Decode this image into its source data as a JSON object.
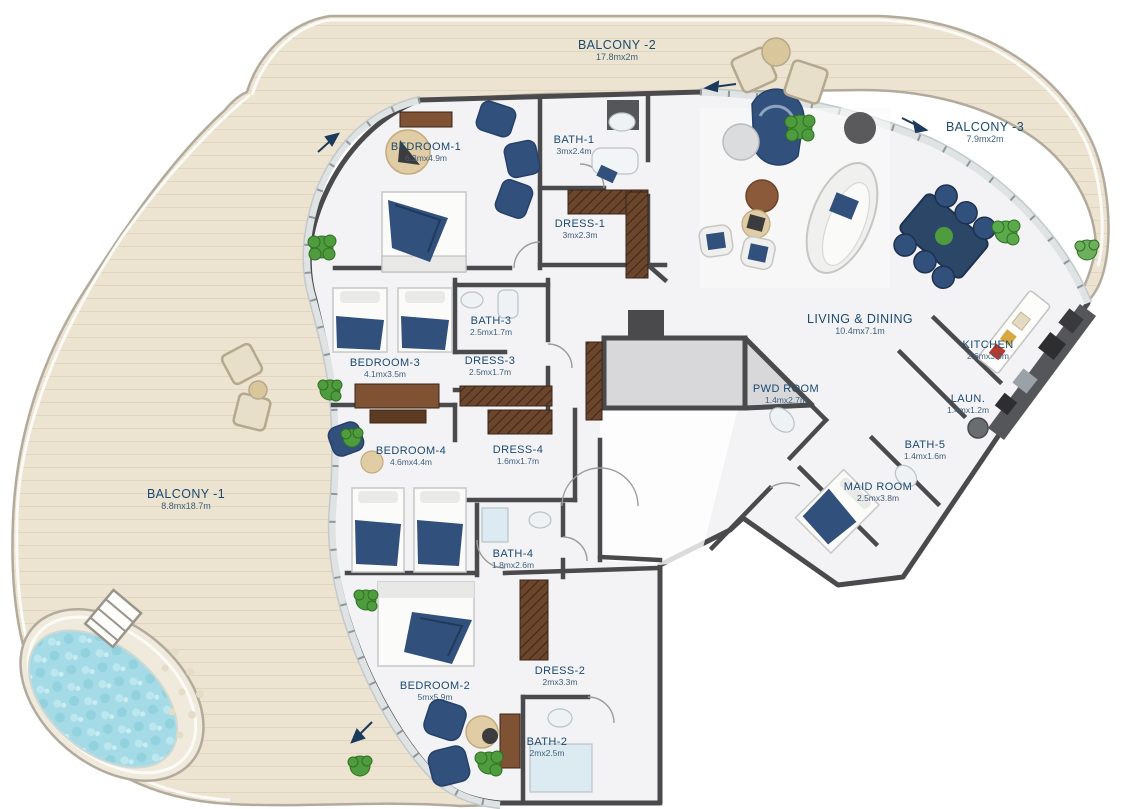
{
  "plan": {
    "type": "apartment-floor-plan",
    "colors": {
      "label_text": "#1b4a70",
      "dims_text": "#40607b",
      "wall": "#4a4a4c",
      "balcony_floor": "#ece3d1",
      "interior_floor": "#f3f3f5",
      "pool_water": "#a5dbe6",
      "furniture_navy": "#31507b",
      "wood": "#7e5233",
      "plant_green": "#4f9c3e"
    },
    "features": [
      "pool",
      "pool-ladder",
      "dining-table",
      "sofa-group",
      "kitchen-counter",
      "beds",
      "plants",
      "balcony-chairs"
    ]
  },
  "rooms": {
    "balcony1": {
      "name": "BALCONY -1",
      "dims": "8.8mx18.7m"
    },
    "balcony2": {
      "name": "BALCONY -2",
      "dims": "17.8mx2m"
    },
    "balcony3": {
      "name": "BALCONY -3",
      "dims": "7.9mx2m"
    },
    "bedroom1": {
      "name": "BEDROOM-1",
      "dims": "6.3mx4.9m"
    },
    "bath1": {
      "name": "BATH-1",
      "dims": "3mx2.4m"
    },
    "dress1": {
      "name": "DRESS-1",
      "dims": "3mx2.3m"
    },
    "living": {
      "name": "LIVING & DINING",
      "dims": "10.4mx7.1m"
    },
    "kitchen": {
      "name": "KITCHEN",
      "dims": "2.6mx3.9m"
    },
    "pwd": {
      "name": "PWD ROOM",
      "dims": "1.4mx2.7m"
    },
    "laun": {
      "name": "LAUN.",
      "dims": "1.4mx1.2m"
    },
    "bath5": {
      "name": "BATH-5",
      "dims": "1.4mx1.6m"
    },
    "maid": {
      "name": "MAID ROOM",
      "dims": "2.5mx3.8m"
    },
    "bath3": {
      "name": "BATH-3",
      "dims": "2.5mx1.7m"
    },
    "dress3": {
      "name": "DRESS-3",
      "dims": "2.5mx1.7m"
    },
    "bedroom3": {
      "name": "BEDROOM-3",
      "dims": "4.1mx3.5m"
    },
    "bedroom4": {
      "name": "BEDROOM-4",
      "dims": "4.6mx4.4m"
    },
    "dress4": {
      "name": "DRESS-4",
      "dims": "1.6mx1.7m"
    },
    "bath4": {
      "name": "BATH-4",
      "dims": "1.8mx2.6m"
    },
    "bedroom2": {
      "name": "BEDROOM-2",
      "dims": "5mx5.9m"
    },
    "dress2": {
      "name": "DRESS-2",
      "dims": "2mx3.3m"
    },
    "bath2": {
      "name": "BATH-2",
      "dims": "2mx2.5m"
    }
  }
}
